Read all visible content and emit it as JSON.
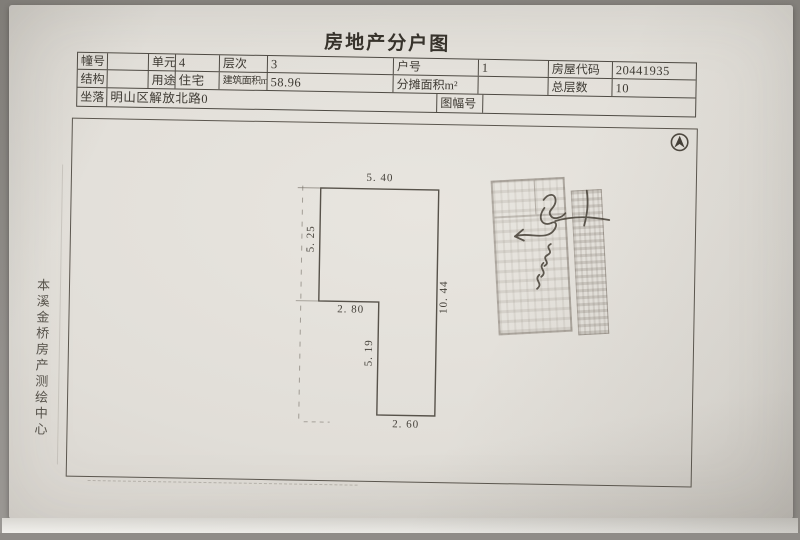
{
  "title": "房地产分户图",
  "agency_label": "本溪金桥房产测绘中心",
  "table": {
    "row1": [
      {
        "label": "幢号",
        "value": ""
      },
      {
        "label": "单元",
        "value": "4"
      },
      {
        "label": "层次",
        "value": "3"
      },
      {
        "label": "户号",
        "value": "1"
      },
      {
        "label": "房屋代码",
        "value": "20441935"
      }
    ],
    "row2": [
      {
        "label": "结构",
        "value": ""
      },
      {
        "label": "用途",
        "value": "住宅"
      },
      {
        "label": "建筑面积m²",
        "value": "58.96"
      },
      {
        "label": "分摊面积m²",
        "value": ""
      },
      {
        "label": "总层数",
        "value": "10"
      }
    ],
    "row3": [
      {
        "label": "坐落",
        "value": "明山区解放北路0"
      },
      {
        "label": "图幅号",
        "value": ""
      }
    ]
  },
  "floor_plan": {
    "dimensions": {
      "top_width": "5. 40",
      "upper_left_height": "5. 25",
      "step_width": "2. 80",
      "lower_inner_height": "5. 19",
      "bottom_width": "2. 60",
      "right_height": "10. 44"
    }
  },
  "icons": {
    "north_arrow": "north-arrow-icon"
  },
  "stamps": {
    "left": "faded illegible rectangular stamp",
    "right": "faded illegible rectangular stamp",
    "signature": "handwritten illegible signature"
  },
  "colors": {
    "paper": "#e1ded8",
    "ink": "#3e3a33",
    "line": "#55504a",
    "stamp": "#6e665c"
  }
}
